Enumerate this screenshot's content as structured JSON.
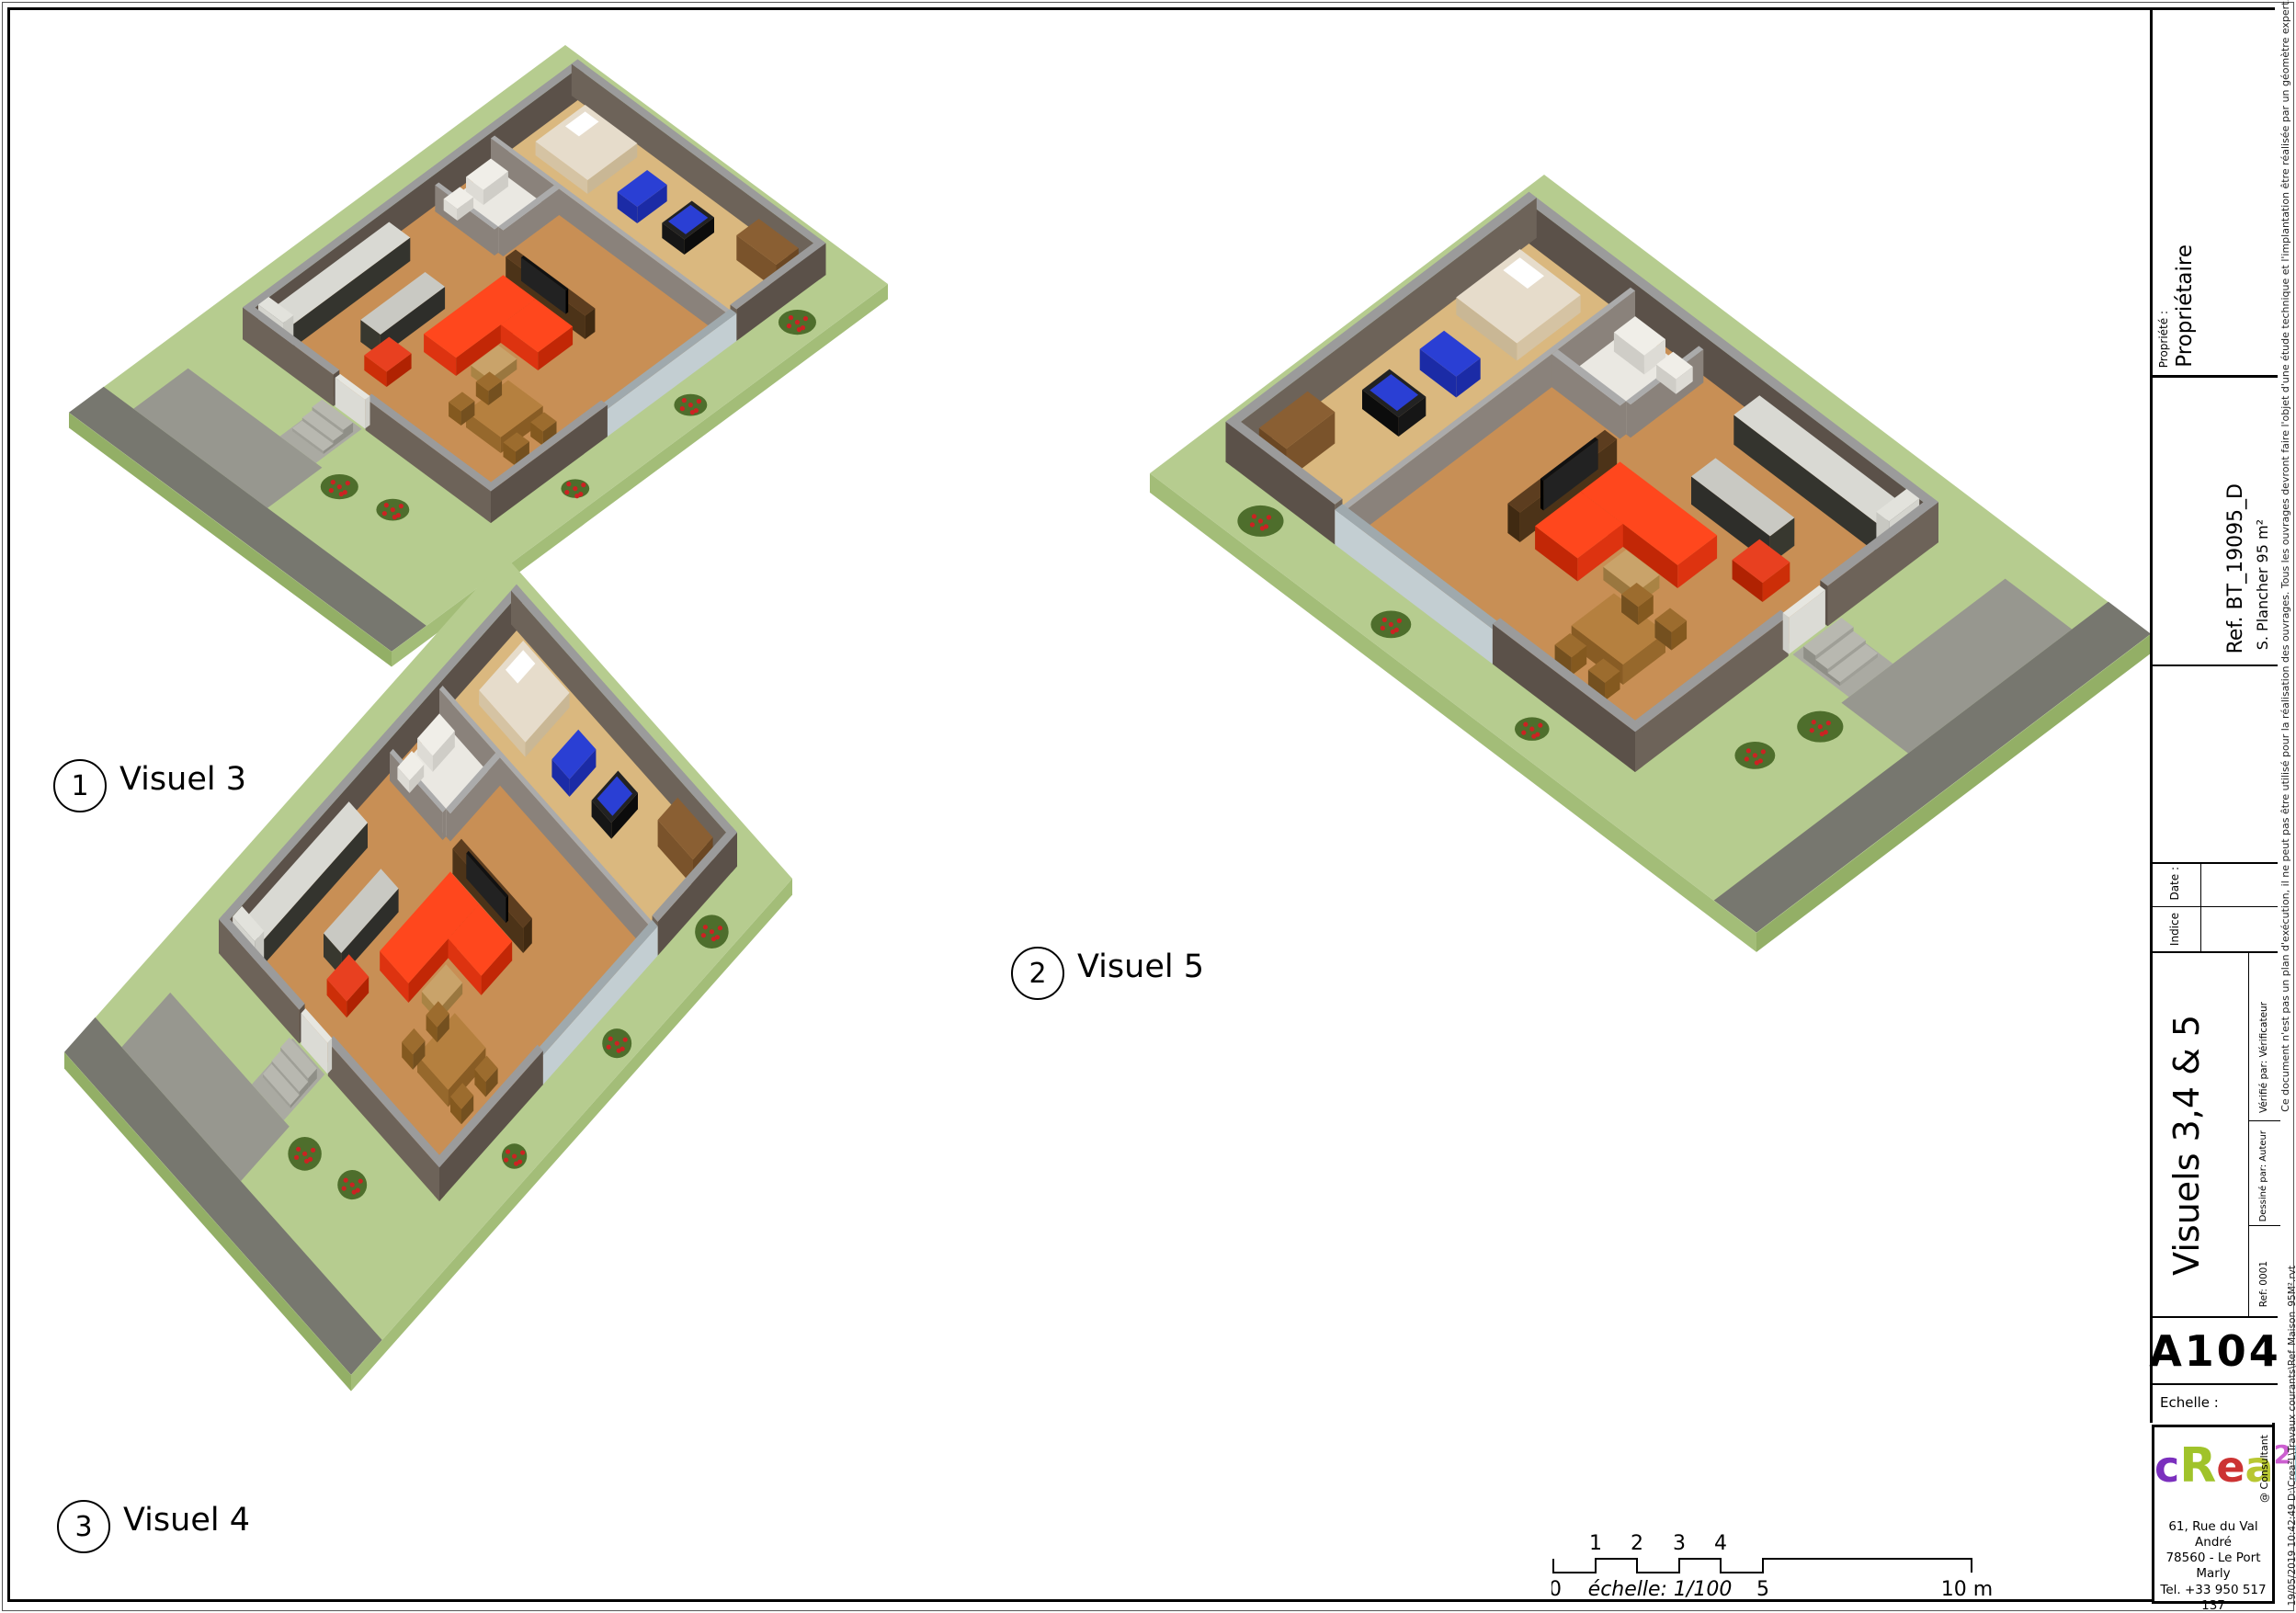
{
  "sheet": {
    "background": "#ffffff",
    "border_color": "#000000"
  },
  "visuals": [
    {
      "circle_label": "1",
      "label": "Visuel 3"
    },
    {
      "circle_label": "2",
      "label": "Visuel 5"
    },
    {
      "circle_label": "3",
      "label": "Visuel 4"
    }
  ],
  "scale_bar": {
    "ticks_above": [
      "1",
      "2",
      "3",
      "4"
    ],
    "tick_zero": "0",
    "tick_five": "5",
    "tick_ten": "10 m",
    "caption": "échelle: 1/100"
  },
  "title_block": {
    "property_label": "Propriété :",
    "property_value": "Propriétaire",
    "floor_area": "S. Plancher 95 m²",
    "reference": "Ref. BT_19095_D",
    "date_label": "Date :",
    "indice_label": "Indice",
    "sheet_title": "Visuels 3,4 & 5",
    "verified_by": "Vérifié par:   Vérificateur",
    "drawn_by": "Dessiné par:   Auteur",
    "ref_field": "Ref:   0001",
    "sheet_number": "A104",
    "scale_label": "Echelle :",
    "consultant": "@ Consultant",
    "address_lines": [
      "61, Rue du Val André",
      "78560 - Le Port Marly",
      "Tel. +33 950 517 137",
      "Fax. +33 955 517 137",
      "www.realcrea.fr",
      "realcrea.fr@gmail.com"
    ],
    "disclaimer": "Ce document n'est pas un plan d'exécution, il ne peut pas être utilisé pour la réalisation des ouvrages. Tous les ouvrages devront faire l'objet d'une étude technique et l'implantation être réalisée par un géomètre expert.",
    "file_info": "19/05/2019 10:42:49   D:\\Crea²L\\Travaux courants\\Ref_Maison_95M².rvt"
  },
  "logo": {
    "letters": [
      {
        "ch": "c",
        "color": "#7b2fbe",
        "size": 46
      },
      {
        "ch": "R",
        "color": "#a0c32a",
        "size": 52
      },
      {
        "ch": "e",
        "color": "#cc3333",
        "size": 46
      },
      {
        "ch": "a",
        "color": "#b8c732",
        "size": 46
      },
      {
        "ch": "2",
        "color": "#cc5fd0",
        "size": 28,
        "sup": true
      },
      {
        "ch": "l",
        "color": "#36b9c9",
        "size": 52
      }
    ]
  },
  "palette": {
    "lawn": "#b6cc8f",
    "lawn_side": "#93af66",
    "lawn_side2": "#a3bd78",
    "road": "#77776f",
    "driveway": "#97978f",
    "path": "#aaaaa2",
    "step": "#b8b8b0",
    "wall_top": "#9b9b9b",
    "wall_dark": "#5b5149",
    "wall_mid": "#6d6359",
    "glass": "#c3ced2",
    "glass_top": "#9fa9ad",
    "floor_wood": "#c88f55",
    "floor_wood_light": "#dab87f",
    "floor_white": "#eae8e2",
    "partition_top": "#ababab",
    "partition_side": "#8a827b",
    "sofa_red": "#ff471d",
    "sofa_red_dark": "#c22706",
    "sofa_red_mid": "#dd3310",
    "furniture_brown": "#b5803f",
    "furniture_brown_dark": "#885c24",
    "counter_top": "#d9d9d3",
    "counter_dark": "#34342e",
    "white_fixture": "#f0eee8",
    "bed": "#e6dccb",
    "gym_blue": "#2a3fd4",
    "gym_blue_dark": "#1b2ba6",
    "bush": "#4e6e2c",
    "bush_flower": "#cc2222"
  }
}
